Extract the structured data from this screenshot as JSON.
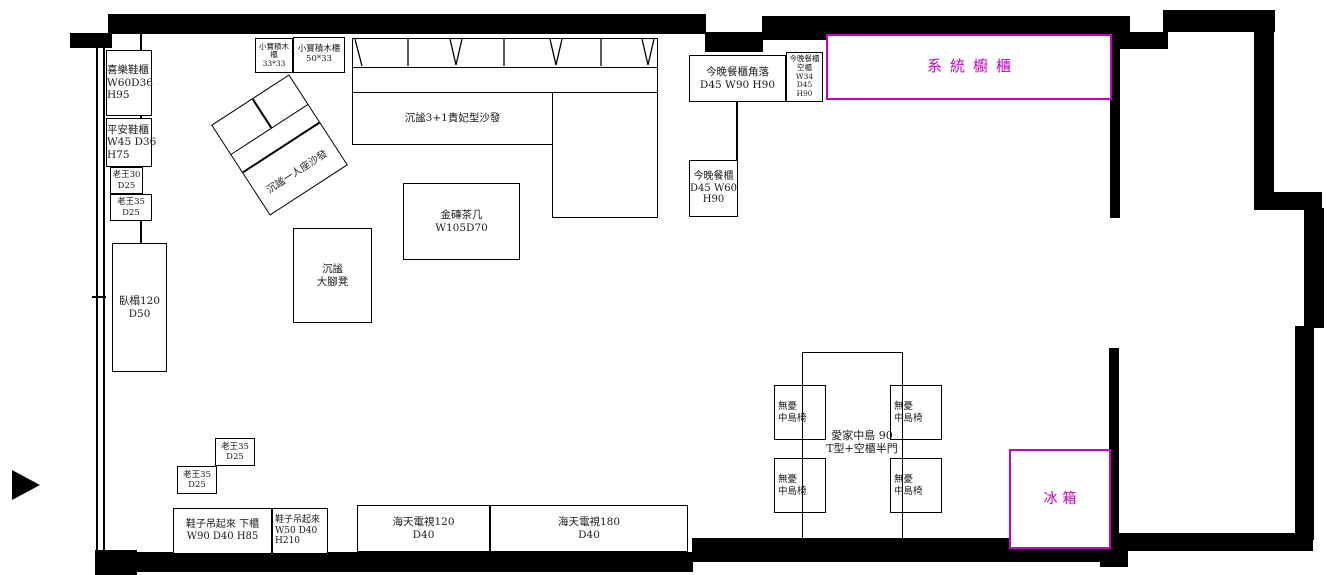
{
  "palette": {
    "accent": "#c400c4",
    "line_color": "#000000"
  },
  "items": {
    "xile_cabinet": {
      "label": "喜樂鞋櫃\nW60D36\nH95"
    },
    "pingan_cabinet": {
      "label": "平安鞋櫃\nW45 D36\nH75"
    },
    "laowang_30": {
      "label": "老王30\nD25"
    },
    "laowang_35_wall": {
      "label": "老王35\nD25"
    },
    "laowang_35_a": {
      "label": "老王35\nD25"
    },
    "laowang_35_b": {
      "label": "老王35\nD25"
    },
    "daybed": {
      "label": "臥榻120\nD50"
    },
    "lego_cabinet_33": {
      "label": "小寶積木櫃\n33*33"
    },
    "lego_cabinet_50": {
      "label": "小寶積木櫃\n50*33"
    },
    "single_sofa": {
      "label": "沉謐一人座沙發"
    },
    "main_sofa": {
      "label": "沉謐3+1貴妃型沙發"
    },
    "coffee_table": {
      "label": "金磚茶几\nW105D70"
    },
    "ottoman": {
      "label": "沉謐\n大腳凳"
    },
    "dinner_cabinet_corner": {
      "label": "今晚餐櫃角落\nD45 W90 H90"
    },
    "dinner_cabinet_empty": {
      "label": "今晚餐櫃\n空櫃\nW34 D45\nH90"
    },
    "dinner_cabinet_60": {
      "label": "今晚餐櫃\nD45 W60\nH90"
    },
    "system_cabinet": {
      "label": "系統櫥櫃"
    },
    "island_label": {
      "label": "愛家中島  90\nT型+空櫃半門"
    },
    "island_chair": {
      "label": "無憂\n中島椅"
    },
    "fridge": {
      "label": "冰箱"
    },
    "tv_120": {
      "label": "海天電視120\nD40"
    },
    "tv_180": {
      "label": "海天電視180\nD40"
    },
    "shoe_cabinet_lower": {
      "label": "鞋子吊起來 下櫃\nW90 D40 H85"
    },
    "shoe_cabinet_hang": {
      "label": "鞋子吊起來\nW50 D40\nH210"
    }
  }
}
